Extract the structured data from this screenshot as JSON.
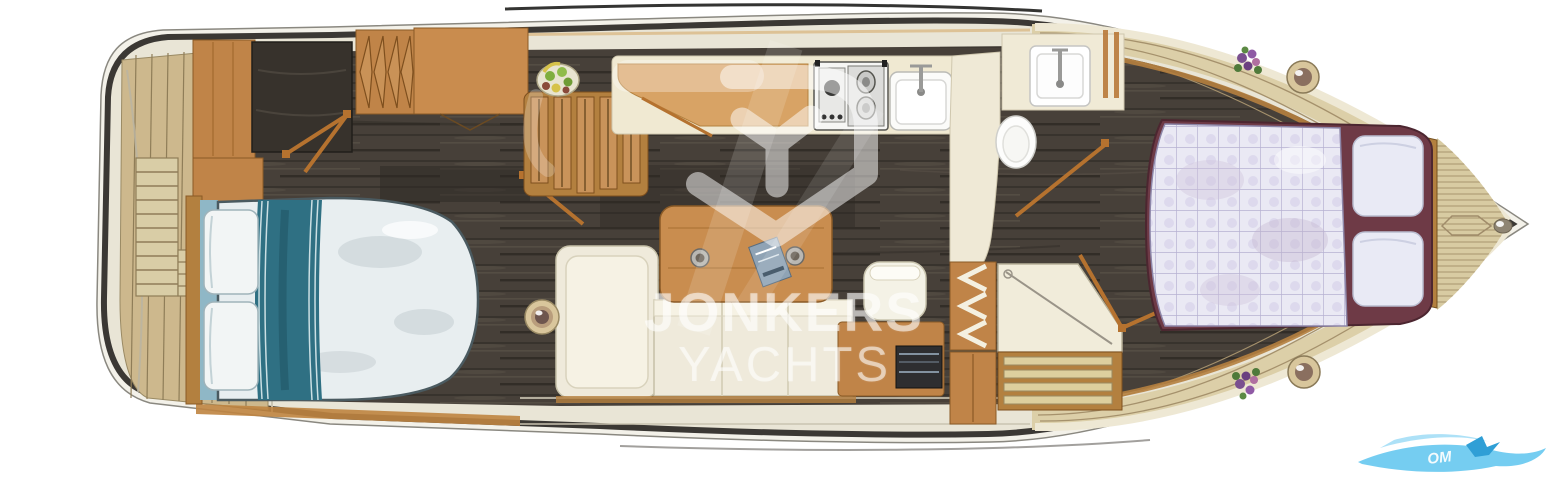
{
  "watermark": {
    "line1": "JONKERS",
    "line2": "YACHTS",
    "logo": "jonkers-y-diamond-logo"
  },
  "corner_watermark": {
    "visible_text": "OM",
    "style": "blue wave swoosh with gull, bottom-right corner"
  },
  "palette": {
    "hull_outline": "#3b3834",
    "gunwale_cream": "#e9e5d6",
    "teak_deck": "#cdb88d",
    "bow_deck": "#dccfa8",
    "interior_floor": "#474039",
    "furniture_wood": "#c08448",
    "trim_orange": "#b5722f",
    "counter_cream": "#f0e9d2",
    "sofa_cream": "#efeadb",
    "bed_runner_teal": "#2f7083",
    "forward_quilt": "#eae9f4",
    "forward_bed_maroon": "#6e3a46",
    "swoosh_blue": "#66c8ef",
    "watermark_white": "rgba(255,255,255,0.55)"
  },
  "fixtures": [
    "swim-platform-ladder",
    "aft-cabin-double-bed",
    "wardrobe-with-hangers",
    "vanity-desk",
    "companionway-steps",
    "fruit-bowl",
    "galley-counter",
    "stove-cooktop",
    "galley-sink",
    "salon-sofa",
    "salon-table",
    "drink-cups",
    "magazine",
    "stool-seat",
    "sideboard-tv",
    "head-sink",
    "toilet",
    "shower-pan",
    "louvered-wardrobe",
    "forward-steps",
    "forward-v-berth",
    "berth-pillows",
    "flower-pots",
    "deck-rings",
    "anchor-hatch",
    "porthole-fitting"
  ]
}
